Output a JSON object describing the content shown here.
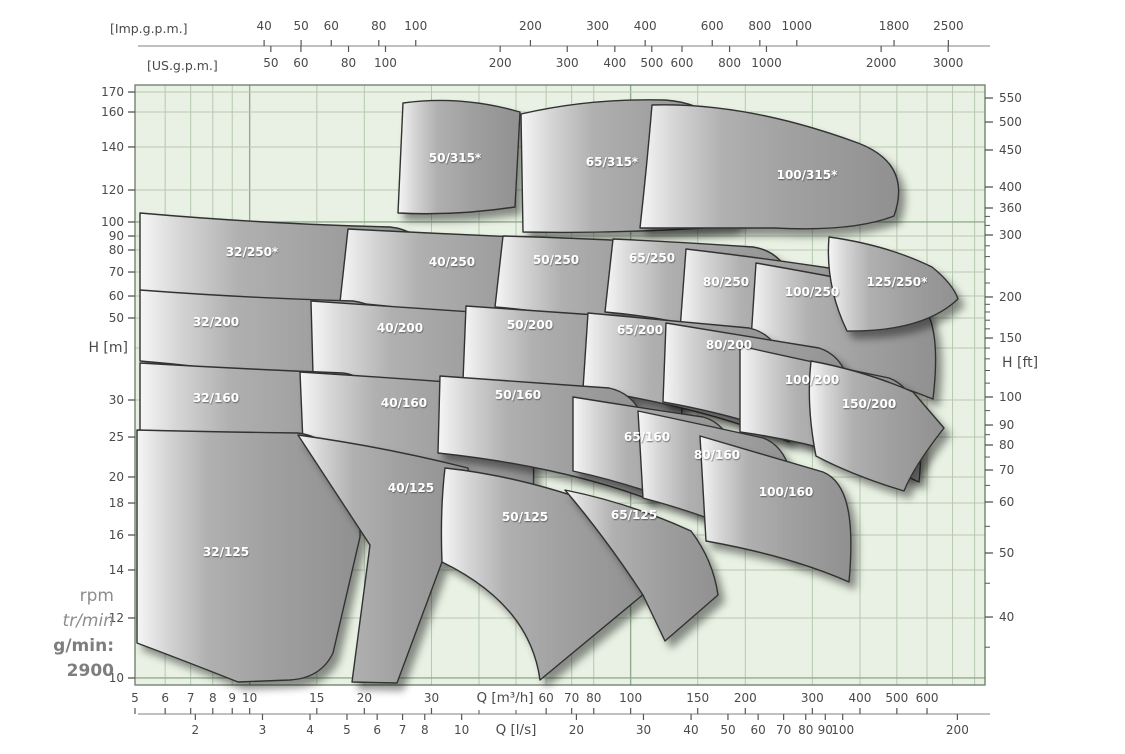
{
  "colors": {
    "page_bg": "#ffffff",
    "plot_bg": "#e8f1e3",
    "grid_minor": "#b6c9b0",
    "grid_major": "#94ac8f",
    "plot_border": "#6a7a68",
    "axis_line": "#9a9a9a",
    "tick_mark": "#555555",
    "tick_text": "#4a4a4a",
    "sail_stroke": "#323232",
    "sail_light": "#f6f6f6",
    "sail_mid": "#aaaaaa",
    "sail_dark": "#8f8f8f",
    "region_label": "#ffffff",
    "rpm_text": "#8d8d8d"
  },
  "rpm_note": {
    "line1": "rpm",
    "line2": "tr/min",
    "line3": "g/min:",
    "line4": "2900"
  },
  "chart_data": {
    "type": "area",
    "subtype": "pump-selection-chart",
    "speed_rpm": 2900,
    "layout": {
      "plot": {
        "x": 135,
        "y": 85,
        "w": 850,
        "h": 600
      },
      "top_line_y": 46,
      "imp_label_y": 30,
      "us_label_y": 67,
      "bottom_line_y": 714,
      "m3h_label_y": 702,
      "ls_label_y": 734
    },
    "axes": {
      "top_imp": {
        "unit": "[Imp.g.p.m.]",
        "ticks": [
          {
            "v": "40",
            "f": 0.1519
          },
          {
            "v": "50",
            "f": 0.1954
          },
          {
            "v": "60",
            "f": 0.2309
          },
          {
            "v": "80",
            "f": 0.2868
          },
          {
            "v": "100",
            "f": 0.3303
          },
          {
            "v": "200",
            "f": 0.4652
          },
          {
            "v": "300",
            "f": 0.5442
          },
          {
            "v": "400",
            "f": 0.6002
          },
          {
            "v": "600",
            "f": 0.6791
          },
          {
            "v": "800",
            "f": 0.7351
          },
          {
            "v": "1000",
            "f": 0.7786
          },
          {
            "v": "1800",
            "f": 0.893
          },
          {
            "v": "2500",
            "f": 0.9569
          }
        ]
      },
      "top_us": {
        "unit": "[US.g.p.m.]",
        "ticks": [
          {
            "v": "50",
            "f": 0.1598
          },
          {
            "v": "60",
            "f": 0.1952
          },
          {
            "v": "80",
            "f": 0.2512
          },
          {
            "v": "100",
            "f": 0.2947
          },
          {
            "v": "200",
            "f": 0.4296
          },
          {
            "v": "300",
            "f": 0.5085
          },
          {
            "v": "400",
            "f": 0.5645
          },
          {
            "v": "500",
            "f": 0.608
          },
          {
            "v": "600",
            "f": 0.6435
          },
          {
            "v": "800",
            "f": 0.6995
          },
          {
            "v": "1000",
            "f": 0.7429
          },
          {
            "v": "2000",
            "f": 0.8778
          },
          {
            "v": "3000",
            "f": 0.9567
          }
        ]
      },
      "left_m": {
        "unit": "H [m]",
        "unit_f": 0.4383,
        "ticks": [
          {
            "v": "170",
            "f": 0.0117
          },
          {
            "v": "160",
            "f": 0.045
          },
          {
            "v": "140",
            "f": 0.1033
          },
          {
            "v": "120",
            "f": 0.175
          },
          {
            "v": "100",
            "f": 0.2283
          },
          {
            "v": "90",
            "f": 0.2517
          },
          {
            "v": "80",
            "f": 0.275
          },
          {
            "v": "70",
            "f": 0.3117
          },
          {
            "v": "60",
            "f": 0.3517
          },
          {
            "v": "50",
            "f": 0.3883
          },
          {
            "v": "30",
            "f": 0.525
          },
          {
            "v": "25",
            "f": 0.5867
          },
          {
            "v": "20",
            "f": 0.6533
          },
          {
            "v": "18",
            "f": 0.6967
          },
          {
            "v": "16",
            "f": 0.75
          },
          {
            "v": "14",
            "f": 0.8083
          },
          {
            "v": "12",
            "f": 0.8883
          },
          {
            "v": "10",
            "f": 0.9883
          }
        ]
      },
      "right_ft": {
        "unit": "H [ft]",
        "unit_f": 0.4633,
        "ticks": [
          {
            "v": "550",
            "f": 0.0217
          },
          {
            "v": "500",
            "f": 0.0617
          },
          {
            "v": "450",
            "f": 0.1083
          },
          {
            "v": "400",
            "f": 0.17
          },
          {
            "v": "360",
            "f": 0.205
          },
          {
            "v": "300",
            "f": 0.25
          },
          {
            "v": "200",
            "f": 0.3533
          },
          {
            "v": "150",
            "f": 0.4217
          },
          {
            "v": "100",
            "f": 0.52
          },
          {
            "v": "90",
            "f": 0.5667
          },
          {
            "v": "80",
            "f": 0.6
          },
          {
            "v": "70",
            "f": 0.6417
          },
          {
            "v": "60",
            "f": 0.695
          },
          {
            "v": "50",
            "f": 0.78
          },
          {
            "v": "40",
            "f": 0.8867
          }
        ],
        "minor_f": [
          0.219,
          0.234,
          0.268,
          0.286,
          0.307,
          0.33,
          0.3655,
          0.3783,
          0.392,
          0.4064,
          0.4384,
          0.4564,
          0.4758,
          0.4969,
          0.5427,
          0.5828,
          0.6201,
          0.6673,
          0.7355,
          0.8304,
          0.937
        ]
      },
      "bottom_m3h": {
        "unit": "Q [m³/h]",
        "unit_f": 0.435,
        "ticks": [
          {
            "v": "5",
            "f": 0.0
          },
          {
            "v": "6",
            "f": 0.0355
          },
          {
            "v": "7",
            "f": 0.0655
          },
          {
            "v": "8",
            "f": 0.0915
          },
          {
            "v": "9",
            "f": 0.1144
          },
          {
            "v": "10",
            "f": 0.1349
          },
          {
            "v": "15",
            "f": 0.2139
          },
          {
            "v": "20",
            "f": 0.2698
          },
          {
            "v": "30",
            "f": 0.3488
          },
          {
            "v": "60",
            "f": 0.4837
          },
          {
            "v": "70",
            "f": 0.5137
          },
          {
            "v": "80",
            "f": 0.5397
          },
          {
            "v": "100",
            "f": 0.5831
          },
          {
            "v": "150",
            "f": 0.662
          },
          {
            "v": "200",
            "f": 0.718
          },
          {
            "v": "300",
            "f": 0.7969
          },
          {
            "v": "400",
            "f": 0.8529
          },
          {
            "v": "500",
            "f": 0.8963
          },
          {
            "v": "600",
            "f": 0.9318
          }
        ],
        "minor_f": [
          0.4047,
          0.4482
        ]
      },
      "bottom_ls": {
        "unit": "Q [l/s]",
        "unit_f": 0.448,
        "ticks": [
          {
            "v": "2",
            "f": 0.071
          },
          {
            "v": "3",
            "f": 0.15
          },
          {
            "v": "4",
            "f": 0.2059
          },
          {
            "v": "5",
            "f": 0.2494
          },
          {
            "v": "6",
            "f": 0.2849
          },
          {
            "v": "7",
            "f": 0.3148
          },
          {
            "v": "8",
            "f": 0.3409
          },
          {
            "v": "10",
            "f": 0.3843
          },
          {
            "v": "20",
            "f": 0.5193
          },
          {
            "v": "30",
            "f": 0.5982
          },
          {
            "v": "40",
            "f": 0.6542
          },
          {
            "v": "50",
            "f": 0.6976
          },
          {
            "v": "60",
            "f": 0.7331
          },
          {
            "v": "70",
            "f": 0.7631
          },
          {
            "v": "80",
            "f": 0.7891
          },
          {
            "v": "90",
            "f": 0.8121
          },
          {
            "v": "100",
            "f": 0.8326
          },
          {
            "v": "200",
            "f": 0.9675
          }
        ]
      }
    },
    "grid": {
      "v_f": [
        0.0355,
        0.0655,
        0.0915,
        0.1144,
        0.1349,
        0.2139,
        0.2698,
        0.3488,
        0.4047,
        0.4482,
        0.4837,
        0.5137,
        0.5397,
        0.5831,
        0.662,
        0.718,
        0.7969,
        0.8529,
        0.8963,
        0.9318,
        0.9618,
        0.9878
      ],
      "v_major_f": [
        0.1349,
        0.5831
      ],
      "h_f": [
        0.0117,
        0.045,
        0.1033,
        0.175,
        0.2283,
        0.2517,
        0.275,
        0.3117,
        0.3517,
        0.3883,
        0.4383,
        0.525,
        0.5867,
        0.6533,
        0.6967,
        0.75,
        0.8083,
        0.8883,
        0.9883
      ],
      "h_major_f": [
        0.2283,
        0.9883
      ]
    },
    "regions": [
      {
        "label": "50/315*",
        "lx": 320,
        "ly": 77,
        "path": "M268,18 Q326,10 385,27 L380,122 Q320,131 263,128 Z"
      },
      {
        "label": "65/315*",
        "lx": 477,
        "ly": 81,
        "path": "M386,29 Q455,13 530,15 C572,18 602,40 611,95 Q613,125 597,141 Q490,149 388,147 Z"
      },
      {
        "label": "100/315*",
        "lx": 672,
        "ly": 94,
        "path": "M517,20 C585,18 655,33 723,58 C757,71 772,94 759,131 Q718,147 640,143 L505,143 Q512,80 517,20 Z"
      },
      {
        "label": "32/250*",
        "lx": 117,
        "ly": 171,
        "path": "M5,128 Q130,139 255,142 C292,146 312,176 316,250 Q160,216 5,206 Z"
      },
      {
        "label": "40/250",
        "lx": 317,
        "ly": 181,
        "path": "M213,144 Q310,149 406,153 C442,157 457,192 451,264 Q340,226 205,217 Z"
      },
      {
        "label": "50/250",
        "lx": 421,
        "ly": 179,
        "path": "M368,151 Q440,153 516,157 C551,161 571,196 566,266 Q470,231 360,222 Z"
      },
      {
        "label": "65/250",
        "lx": 517,
        "ly": 177,
        "path": "M478,154 Q545,157 618,162 C652,167 671,201 666,275 Q575,236 470,227 Z"
      },
      {
        "label": "80/250",
        "lx": 591,
        "ly": 201,
        "path": "M551,164 Q620,172 694,183 C726,192 741,226 734,296 Q645,256 545,245 Z"
      },
      {
        "label": "100/250",
        "lx": 677,
        "ly": 211,
        "path": "M621,178 Q690,190 766,205 C796,215 806,246 798,314 Q715,281 615,270 Z"
      },
      {
        "label": "125/250*",
        "lx": 762,
        "ly": 201,
        "path": "M694,152 Q752,160 797,182 Q818,199 823,214 Q788,247 712,246 Q690,200 694,152 Z"
      },
      {
        "label": "32/200",
        "lx": 81,
        "ly": 241,
        "path": "M5,205 Q110,213 218,216 C254,221 278,252 294,322 Q150,288 5,276 Z"
      },
      {
        "label": "40/200",
        "lx": 265,
        "ly": 247,
        "path": "M176,216 Q275,223 381,230 C416,236 432,271 428,337 Q310,301 178,289 Z"
      },
      {
        "label": "50/200",
        "lx": 395,
        "ly": 244,
        "path": "M331,221 Q415,227 504,233 C536,240 551,273 546,342 Q450,308 328,296 Z"
      },
      {
        "label": "65/200",
        "lx": 505,
        "ly": 249,
        "path": "M453,228 Q530,235 614,243 C646,250 660,283 654,357 Q565,321 448,304 Z"
      },
      {
        "label": "80/200",
        "lx": 594,
        "ly": 264,
        "path": "M531,238 Q600,249 684,263 C713,272 724,306 718,377 Q635,336 528,317 Z"
      },
      {
        "label": "100/200",
        "lx": 677,
        "ly": 299,
        "path": "M605,261 Q672,276 754,293 C781,303 790,336 784,397 Q705,361 605,347 Z"
      },
      {
        "label": "150/200",
        "lx": 734,
        "ly": 323,
        "path": "M676,276 Q730,286 778,307 L809,343 Q779,381 769,406 Q719,391 681,371 Q671,320 676,276 Z"
      },
      {
        "label": "32/160",
        "lx": 81,
        "ly": 317,
        "path": "M5,278 Q105,284 208,288 C242,293 265,324 284,393 Q145,356 5,346 Z"
      },
      {
        "label": "40/160",
        "lx": 269,
        "ly": 322,
        "path": "M165,287 Q260,293 354,300 C387,306 402,341 398,410 Q290,371 168,358 Z"
      },
      {
        "label": "50/160",
        "lx": 383,
        "ly": 314,
        "path": "M305,291 Q385,297 474,303 C507,310 520,343 516,415 Q425,381 303,368 Z"
      },
      {
        "label": "65/160",
        "lx": 512,
        "ly": 356,
        "path": "M438,312 Q500,322 568,332 C597,340 610,373 606,447 Q530,406 438,386 Z"
      },
      {
        "label": "80/160",
        "lx": 582,
        "ly": 374,
        "path": "M503,326 Q560,338 628,353 C654,362 665,396 661,473 Q595,436 508,413 Z"
      },
      {
        "label": "100/160",
        "lx": 651,
        "ly": 411,
        "path": "M565,351 Q620,367 688,387 C712,397 720,431 714,497 Q655,471 571,456 Z"
      },
      {
        "label": "32/125",
        "lx": 91,
        "ly": 471,
        "path": "M2,345 Q80,347 163,348 C207,354 226,400 225,452 L198,568 Q186,593 155,595 L103,597 Q50,576 2,558 Z"
      },
      {
        "label": "40/125",
        "lx": 276,
        "ly": 407,
        "path": "M163,350 Q250,362 333,383 Q341,425 307,477 L262,598 L217,597 L235,460 Q196,400 163,350 Z"
      },
      {
        "label": "50/125",
        "lx": 390,
        "ly": 436,
        "path": "M310,383 Q385,391 465,420 Q498,452 510,508 L405,595 Q395,520 307,477 Q305,425 310,383 Z"
      },
      {
        "label": "65/125",
        "lx": 499,
        "ly": 434,
        "path": "M430,405 Q495,418 556,446 Q578,475 583,510 L530,556 L508,510 Q470,452 430,405 Z"
      }
    ]
  }
}
